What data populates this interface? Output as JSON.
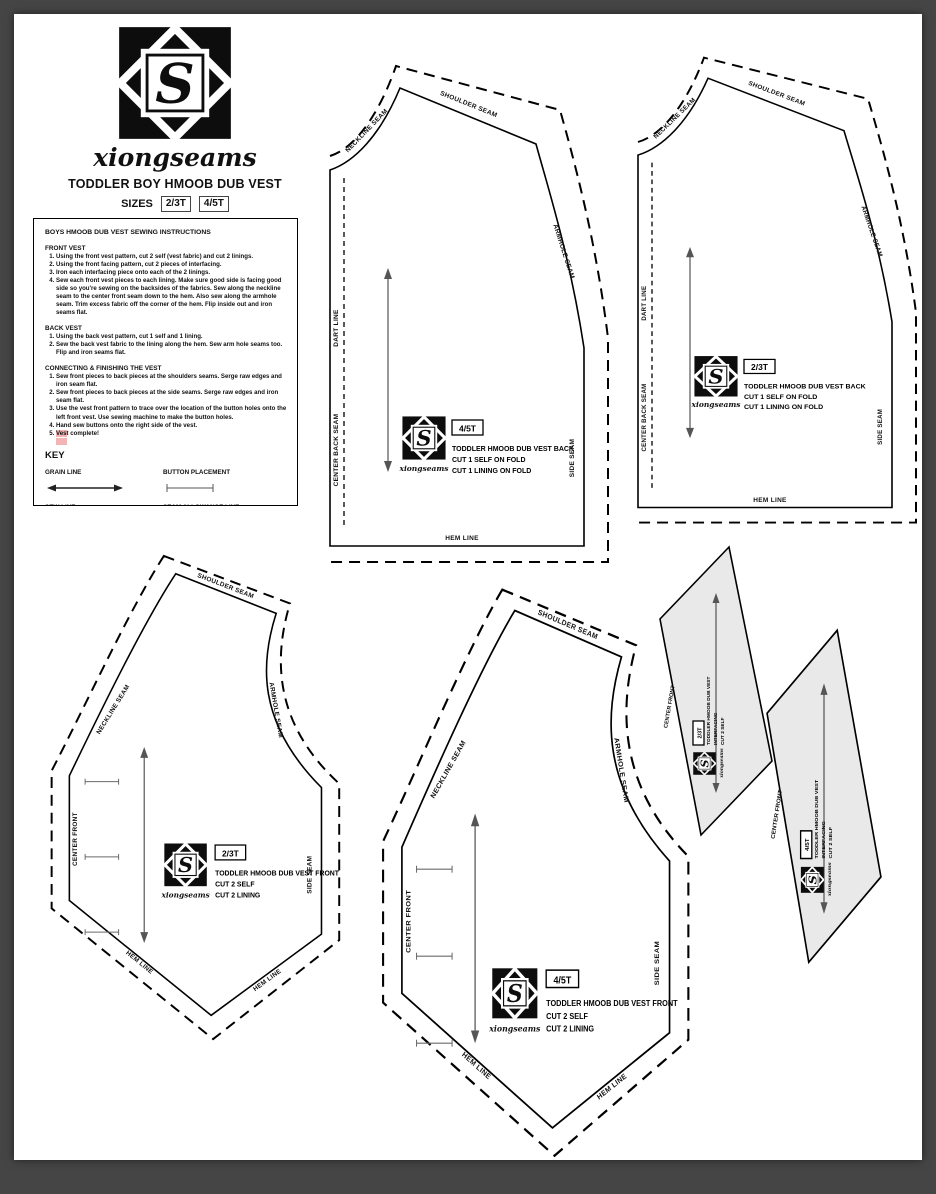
{
  "colors": {
    "frame": "#454545",
    "page": "#ffffff",
    "facing_fill": "#e9e9e9",
    "highlight": "#f2b4b4"
  },
  "header": {
    "brand": "xiongseams",
    "title": "TODDLER BOY HMOOB DUB VEST",
    "sizes_label": "SIZES",
    "size_small": "2/3T",
    "size_large": "4/5T"
  },
  "logo_letter": "S",
  "instructions": {
    "title": "BOYS HMOOB DUB VEST SEWING INSTRUCTIONS",
    "front": {
      "heading": "FRONT VEST",
      "steps": [
        "Using the front vest pattern, cut 2 self (vest fabric) and cut 2 linings.",
        "Using the front facing pattern, cut 2 pieces of interfacing.",
        "Iron each interfacing piece onto each of the 2 linings.",
        "Sew each front vest pieces to each lining. Make sure good side is facing good side so you're sewing on the backsides of the fabrics. Sew along the neckline seam to the center front seam down to the hem. Also sew along the armhole seam. Trim excess fabric off the corner of the hem. Flip inside out and iron seams flat."
      ]
    },
    "back": {
      "heading": "BACK VEST",
      "steps": [
        "Using the back vest pattern, cut 1 self and 1 lining.",
        "Sew the back vest fabric to the lining along the hem. Sew arm hole seams too. Flip and iron seams flat."
      ]
    },
    "finish": {
      "heading": "CONNECTING & FINISHING THE VEST",
      "steps": [
        "Sew front pieces to back pieces at the shoulders seams. Serge raw edges and iron seam flat.",
        "Sew front pieces to back pieces at the side seams. Serge raw edges and iron seam flat.",
        "Use the vest front pattern to trace over the location of the button holes onto the left front vest. Use sewing machine to make the button holes.",
        "Hand sew buttons onto the right side of the vest."
      ],
      "final_hl": "Ves",
      "final_rest": "t complete!"
    }
  },
  "key": {
    "heading": "KEY",
    "grain": "GRAIN LINE",
    "button": "BUTTON PLACEMENT",
    "sew": "SEW LINE",
    "allowance": "SEAM ALLOWANCE LINE"
  },
  "seams": {
    "neckline": "NECKLINE SEAM",
    "shoulder": "SHOULDER SEAM",
    "armhole": "ARMHOLE SEAM",
    "dart": "DART LINE",
    "center_back": "CENTER BACK SEAM",
    "center_front": "CENTER FRONT",
    "side": "SIDE SEAM",
    "hem": "HEM LINE"
  },
  "pieces": {
    "back45": {
      "size": "4/5T",
      "name": "TODDLER HMOOB DUB VEST BACK",
      "cut_a": "CUT 1 SELF ON FOLD",
      "cut_b": "CUT 1 LINING ON FOLD"
    },
    "back23": {
      "size": "2/3T",
      "name": "TODDLER HMOOB DUB VEST BACK",
      "cut_a": "CUT 1 SELF ON FOLD",
      "cut_b": "CUT 1 LINING ON FOLD"
    },
    "front23": {
      "size": "2/3T",
      "name": "TODDLER HMOOB DUB VEST FRONT",
      "cut_a": "CUT 2 SELF",
      "cut_b": "CUT 2 LINING"
    },
    "front45": {
      "size": "4/5T",
      "name": "TODDLER HMOOB DUB VEST FRONT",
      "cut_a": "CUT 2 SELF",
      "cut_b": "CUT 2 LINING"
    },
    "facing23": {
      "size": "2/3T",
      "line1": "TODDLER HMOOB DUB VEST",
      "line2": "INTERFACING",
      "line3": "CUT 2 SELF"
    },
    "facing45": {
      "size": "4/5T",
      "line1": "TODDLER HMOOB DUB VEST",
      "line2": "INTERFACING",
      "line3": "CUT 2 SELF"
    }
  }
}
